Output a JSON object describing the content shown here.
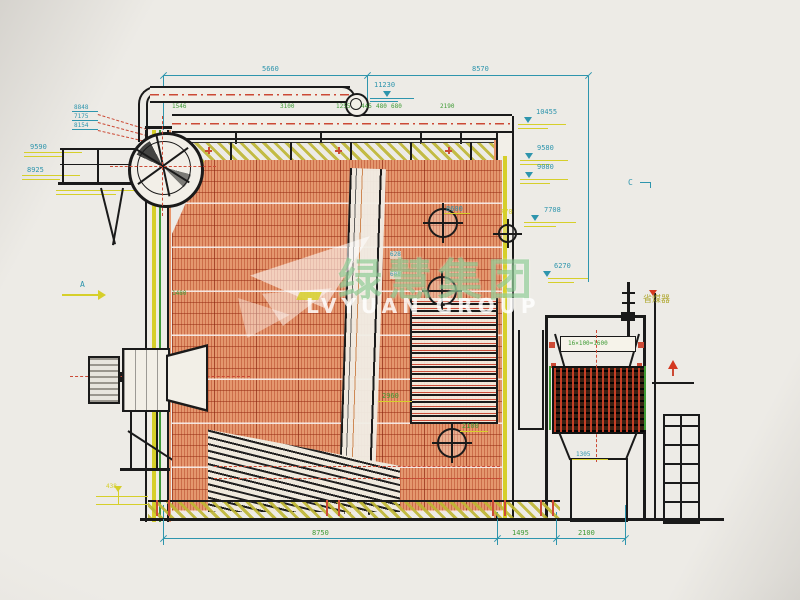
{
  "drawing": {
    "kind": "boiler-side-section-cad-drawing",
    "watermark": {
      "cjk": "绿慧集团",
      "latin": "LVYUAN GROUP"
    },
    "colors": {
      "dimension_cyan": "#2e95ad",
      "dimension_green": "#3f9b35",
      "annotation_yellow": "#d6cf2a",
      "centerline_red": "#cc4a35",
      "wall_orange": "#e09067",
      "line_black": "#1a1a1a",
      "paper": "#eae7e1",
      "watermark_green": "#6fb870"
    },
    "labels": {
      "top_left_span": "5660",
      "top_right_span": "8570",
      "level_11230": "11230",
      "r1": "1546",
      "r2": "3100",
      "r3": "1255",
      "r4": "445",
      "r5": "480",
      "r6": "680",
      "r7": "2190",
      "elev_10455": "10455",
      "elev_9580": "9580",
      "elev_9080": "9080",
      "elev_7708": "7708",
      "elev_6270": "6270",
      "left_stack_1": "8848",
      "left_stack_2": "7175",
      "left_stack_3": "8154",
      "left_9590": "9590",
      "left_8925": "8925",
      "section_a": "A",
      "section_c": "C",
      "mid_8600": "8600",
      "mid_770": "770",
      "mid_628": "628",
      "mid_608": "608",
      "mid_1480": "1480",
      "mid_2960": "2960",
      "mid_2100": "2100",
      "base_438": "438",
      "eco_name": "省煤器",
      "eco_spec": "16×100=1600",
      "eco_1305": "1305",
      "bottom_8750": "8750",
      "bottom_1495": "1495",
      "bottom_2100": "2100"
    }
  }
}
